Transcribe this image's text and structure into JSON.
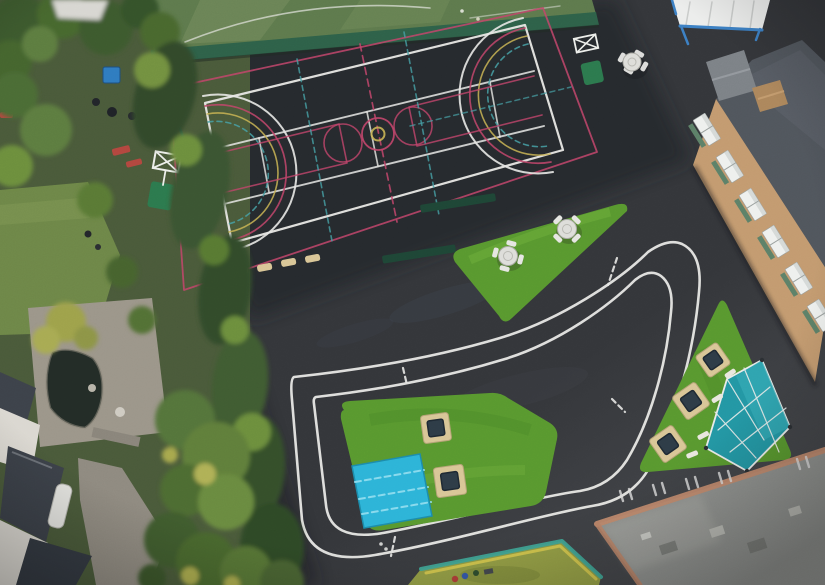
{
  "meta": {
    "caption": "Aerial drone view of a school playground: multi-sport court with white, pink, teal and yellow markings, painted white roadway circuit, artificial turf islands with round tables, in-ground trampolines, a blue mat and a teal canopy, bordered by residential gardens, trees and school buildings."
  },
  "scene": {
    "areas": [
      "multi-sport-court",
      "astro-pitch",
      "cycle-track-circuit",
      "turf-island-with-tables",
      "turf-island-with-trampolines-and-mat",
      "turf-island-with-trampolines-and-canopy",
      "outdoor-classroom-canopy",
      "school-brick-building",
      "flat-roof-building",
      "neighbour-gardens",
      "play-area"
    ],
    "counts": {
      "round_tables": 3,
      "trampolines": 5,
      "basketball_hoops": 2,
      "benches": 4
    }
  },
  "palette": {
    "asphalt": "#34363a",
    "asphalt_dark": "#232529",
    "asphalt_light": "#85878a",
    "line_white": "#e8e8e5",
    "court_pink": "#c2456b",
    "court_teal": "#46a0a5",
    "court_yellow": "#c9b454",
    "turf": "#59992f",
    "turf_dark": "#4a8628",
    "turf_light": "#72b13e",
    "blue_mat": "#2db4d8",
    "blue_mat_light": "#8edcee",
    "canopy_teal": "#2397a4",
    "canopy_white": "#ecedec",
    "frame_blue": "#3c80c4",
    "fence_green": "#2e6149",
    "hedge_dark": "#36512b",
    "hedge_mid": "#4d6c33",
    "hedge_light": "#6d8f3c",
    "hedge_yellow": "#a6a64d",
    "lawn": "#6e8748",
    "patio": "#9c968a",
    "pond": "#232c27",
    "concrete": "#8f8a80",
    "house_roof": "#3d424a",
    "wall_white": "#dbd8d1",
    "roof_slate": "#51565d",
    "roof_grey": "#8f918e",
    "brick": "#c39b70",
    "brick_salmon": "#c08a6e",
    "window_white": "#eef0ee",
    "sill_green": "#5d8168",
    "bench_tan": "#d9c697",
    "trampoline_pit": "#2e3c47",
    "bin_blue": "#2f7cc0",
    "bench_red": "#b3473f",
    "play_olive": "#939d45",
    "play_yellow": "#d2c54d",
    "play_border_teal": "#3fa496",
    "astro_green": "#5e7a4d",
    "astro_light": "#70895a",
    "table_white": "#dededa"
  }
}
